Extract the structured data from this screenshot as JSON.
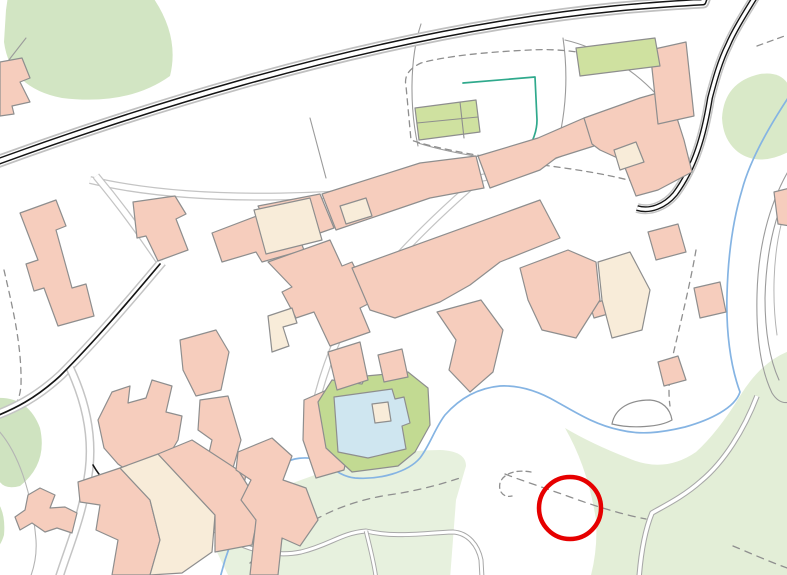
{
  "map": {
    "canvas": {
      "width": 787,
      "height": 575,
      "background": "#ffffff"
    },
    "colors": {
      "background": "#ffffff",
      "building_residential": "#f6cdbd",
      "building_secondary": "#f8ecd9",
      "building_public_green": "#cfe1a0",
      "building_outline": "#8e8e8e",
      "vegetation_dark": "#d2e5c3",
      "vegetation_mid": "#d9e9c8",
      "vegetation_pale": "#e7f1de",
      "pool_water": "#cfe6f0",
      "pool_garden": "#c2da92",
      "stream_blue": "#85b4e3",
      "hedge_teal": "#2fa98c",
      "road_casing_black": "#151515",
      "road_fill_white": "#ffffff",
      "road_casing_gray": "#c4c4c4",
      "track_gray": "#a8a8a8",
      "parcel_gray": "#9b9b9b",
      "path_dash_gray": "#8f8f8f",
      "annotation_red": "#e60000"
    },
    "features": [
      {
        "name": "vegetation-top-left",
        "kind": "area",
        "fill": "#d2e5c3",
        "d": "M8,-4 L152,-4 Q180,36 170,76 Q128,106 62,98 Q10,88 4,42 L6,10 Z"
      },
      {
        "name": "vegetation-right-top",
        "kind": "area",
        "fill": "#d9e9c8",
        "d": "M722,118 Q724,82 760,74 Q787,70 792,95 L792,150 Q760,168 738,152 Q723,140 722,118 Z"
      },
      {
        "name": "vegetation-left-mid",
        "kind": "area",
        "fill": "#cfe3c0",
        "d": "M-4,398 Q28,396 40,428 Q48,464 20,486 Q-2,492 -4,470 Z"
      },
      {
        "name": "vegetation-left-bottom-sliver",
        "kind": "area",
        "fill": "#cfe3c0",
        "d": "M-4,500 Q6,512 4,535 Q0,548 -4,546 Z"
      },
      {
        "name": "vegetation-bottom-center",
        "kind": "area",
        "fill": "#e7f1de",
        "d": "M230,579 L214,546 Q220,518 244,502 Q260,492 290,484 L345,464 Q395,450 440,450 Q466,451 466,466 L456,500 L450,579 Z"
      },
      {
        "name": "vegetation-bottom-right",
        "kind": "area",
        "fill": "#e3eed7",
        "d": "M565,428 Q588,468 596,520 Q598,550 590,579 L792,579 L792,350 Q762,360 740,396 Q718,432 696,452 Q664,474 628,458 Q592,444 565,428 Z"
      },
      {
        "name": "parcel-line-top-left",
        "kind": "line",
        "stroke": "#9b9b9b",
        "width": 1.1,
        "d": "M26,38 L-2,74"
      },
      {
        "name": "parcel-line-field-divider",
        "kind": "line",
        "stroke": "#9b9b9b",
        "width": 1.1,
        "d": "M310,118 L326,178"
      },
      {
        "name": "parcel-line-west",
        "kind": "line",
        "stroke": "#9b9b9b",
        "width": 1.1,
        "d": "M421,24 C409,60 410,110 418,146"
      },
      {
        "name": "parcel-line-south",
        "kind": "line",
        "stroke": "#9b9b9b",
        "width": 1.1,
        "d": "M418,143 C440,150 462,154 481,157"
      },
      {
        "name": "parcel-line-east",
        "kind": "line",
        "stroke": "#9b9b9b",
        "width": 1.1,
        "d": "M563,38 C568,72 567,112 556,150"
      },
      {
        "name": "parcel-line-northeast",
        "kind": "line",
        "stroke": "#9b9b9b",
        "width": 1.1,
        "d": "M565,40 C600,48 634,70 657,95 C667,108 668,124 661,138"
      },
      {
        "name": "trail-right-outer",
        "kind": "line",
        "stroke": "#9b9b9b",
        "width": 1.1,
        "d": "M790,168 C768,205 758,250 757,295 C756,335 760,368 772,393 C777,401 783,404 790,402"
      },
      {
        "name": "trail-right-inner",
        "kind": "line",
        "stroke": "#9b9b9b",
        "width": 1.1,
        "d": "M790,186 C773,218 766,258 765,298 C765,330 769,358 779,380"
      },
      {
        "name": "trail-right-hairpin",
        "kind": "line",
        "stroke": "#b4b4b4",
        "width": 1,
        "d": "M781,225 C773,258 772,300 777,335"
      },
      {
        "name": "boundary-bottom-left",
        "kind": "line",
        "stroke": "#b4b4b4",
        "width": 1.1,
        "d": "M-2,430 C18,452 32,492 36,540 C37,556 34,568 30,578"
      },
      {
        "name": "footpath-dashed-parcel-loop",
        "kind": "line",
        "stroke": "#8f8f8f",
        "width": 1.3,
        "dash": "6,5",
        "d": "M628,66 C600,54 565,48 530,50 C487,52 446,56 421,63 C408,69 404,77 406,86 L411,140 C440,150 492,158 542,165 C582,170 616,176 643,184"
      },
      {
        "name": "footpath-dashed-top-right",
        "kind": "line",
        "stroke": "#8f8f8f",
        "width": 1.3,
        "dash": "6,5",
        "d": "M757,46 L790,34"
      },
      {
        "name": "footpath-dashed-center-right",
        "kind": "line",
        "stroke": "#8f8f8f",
        "width": 1.3,
        "dash": "6,5",
        "d": "M696,250 C690,285 680,325 673,355 C669,375 668,392 670,406"
      },
      {
        "name": "footpath-dashed-left-edge",
        "kind": "line",
        "stroke": "#8f8f8f",
        "width": 1.3,
        "dash": "6,5",
        "d": "M4,270 C12,305 22,345 21,385 C20,400 14,410 6,416"
      },
      {
        "name": "footpath-dashed-bottom",
        "kind": "line",
        "stroke": "#8f8f8f",
        "width": 1.3,
        "dash": "7,6",
        "d": "M250,563 C262,552 290,532 322,516 C345,504 372,497 395,494 C420,490 442,484 460,478"
      },
      {
        "name": "footpath-dashed-through-circle",
        "kind": "line",
        "stroke": "#8f8f8f",
        "width": 1.3,
        "dash": "7,6",
        "d": "M505,474 C520,480 545,488 570,497 C592,505 620,514 646,519"
      },
      {
        "name": "footpath-dashed-corner",
        "kind": "line",
        "stroke": "#8f8f8f",
        "width": 1.3,
        "dash": "7,6",
        "d": "M733,546 C750,553 770,562 790,569"
      },
      {
        "name": "footpath-end-squiggle",
        "kind": "line",
        "stroke": "#8f8f8f",
        "width": 1.3,
        "dash": "5,4",
        "d": "M531,472 C515,469 503,474 500,483 C498,492 504,498 512,496"
      },
      {
        "name": "track-bottom-right",
        "kind": "road",
        "casing": "#a8a8a8",
        "casing_width": 5.5,
        "fill": "#ffffff",
        "fill_width": 3.4,
        "d": "M757,396 C744,430 724,462 701,481 C683,497 664,506 652,513 C645,530 641,552 639,578"
      },
      {
        "name": "track-bottom-center",
        "kind": "road",
        "casing": "#a8a8a8",
        "casing_width": 5,
        "fill": "#ffffff",
        "fill_width": 3,
        "d": "M211,528 C242,549 272,558 301,552 C330,545 341,533 366,531 C396,538 422,533 453,532 C468,533 478,545 481,560 L482,578"
      },
      {
        "name": "track-bottom-branch",
        "kind": "road",
        "casing": "#a8a8a8",
        "casing_width": 4.5,
        "fill": "#ffffff",
        "fill_width": 2.6,
        "d": "M366,531 C370,548 374,562 376,578"
      },
      {
        "name": "street-field-south",
        "kind": "road",
        "casing": "#c4c4c4",
        "casing_width": 8,
        "fill": "#ffffff",
        "fill_width": 5.5,
        "d": "M90,180 C200,206 360,198 470,180 C530,170 570,150 600,132 C622,120 648,120 672,135"
      },
      {
        "name": "street-village-diagonal",
        "kind": "road",
        "casing": "#c4c4c4",
        "casing_width": 8,
        "fill": "#ffffff",
        "fill_width": 5.5,
        "d": "M478,180 C420,230 372,280 342,330 C327,360 317,395 312,422"
      },
      {
        "name": "street-connector-north",
        "kind": "road",
        "casing": "#c4c4c4",
        "casing_width": 8,
        "fill": "#ffffff",
        "fill_width": 5.5,
        "d": "M160,262 C140,232 116,200 96,176"
      },
      {
        "name": "road-village-southwest",
        "kind": "road",
        "casing": "#c4c4c4",
        "casing_width": 10,
        "fill": "#ffffff",
        "fill_width": 7,
        "d": "M162,262 C130,300 96,340 61,375 C36,398 15,408 -6,416"
      },
      {
        "name": "road-village-south-branch",
        "kind": "road",
        "casing": "#c4c4c4",
        "casing_width": 9,
        "fill": "#ffffff",
        "fill_width": 6,
        "d": "M70,368 C86,402 93,436 89,470 C83,516 69,546 59,578"
      },
      {
        "name": "road-village-centerline",
        "kind": "line",
        "stroke": "#151515",
        "width": 1.7,
        "d": "M160,264 C128,302 95,341 60,376 C35,399 14,409 -6,417"
      },
      {
        "name": "road-village-branch-black-edge",
        "kind": "line",
        "stroke": "#151515",
        "width": 1.6,
        "d": "M93,465 C101,479 110,487 120,491"
      },
      {
        "name": "main-road-outer-casing",
        "kind": "road",
        "casing": "#c0c0c0",
        "casing_width": 13,
        "fill": "#ffffff",
        "fill_width": 9.5,
        "d": "M-6,163 C150,106 330,52 500,24 C590,9 650,5 703,2 L706,-6"
      },
      {
        "name": "main-road",
        "kind": "road",
        "casing": "#151515",
        "casing_width": 7,
        "fill": "#ffffff",
        "fill_width": 4,
        "d": "M-6,163 C150,106 330,52 500,24 C590,9 650,5 703,2 L706,-6"
      },
      {
        "name": "fork-road-outer-casing",
        "kind": "road",
        "casing": "#c4c4c4",
        "casing_width": 10,
        "fill": "#ffffff",
        "fill_width": 7,
        "d": "M757,-6 C742,18 733,33 728,45 C720,61 715,79 710,98 C704,135 695,167 675,194 C665,206 650,212 637,208"
      },
      {
        "name": "fork-road",
        "kind": "road",
        "casing": "#151515",
        "casing_width": 6,
        "fill": "#ffffff",
        "fill_width": 3.2,
        "d": "M757,-6 C742,18 733,33 728,45 C720,61 715,79 710,98 C704,135 695,167 675,194 C665,206 650,212 637,208"
      },
      {
        "name": "hedge-teal-line",
        "kind": "line",
        "stroke": "#2fa98c",
        "width": 1.7,
        "d": "M463,83 L535,77 L537,120 C537,135 530,145 526,153"
      },
      {
        "name": "stream",
        "kind": "line",
        "stroke": "#85b4e3",
        "width": 1.7,
        "d": "M790,95 C770,125 750,160 742,190 C733,220 728,255 727,295 C726,330 730,365 740,392 C735,408 710,420 685,427 C660,433 640,435 620,430 C595,425 575,412 557,402 C540,392 520,385 500,386 C478,388 460,398 445,415 C435,428 430,445 420,458 C408,472 380,480 355,478 C338,476 330,465 320,460 C305,456 292,458 283,464 C270,472 262,485 255,495 C240,515 230,545 225,560 L220,578"
      },
      {
        "name": "enclosure-by-stream",
        "kind": "area",
        "fill": "#ffffff",
        "stroke": "#8e8e8e",
        "stroke_width": 1.2,
        "d": "M612,424 C615,408 630,400 650,400 C662,401 670,408 672,420 C660,427 632,429 612,424 Z"
      },
      {
        "name": "building",
        "kind": "building",
        "fill": "#f6cdbd",
        "points": "0,62 22,58 30,78 20,82 30,102 12,106 14,114 0,116"
      },
      {
        "name": "building",
        "kind": "building",
        "fill": "#f6cdbd",
        "points": "20,213 56,200 66,226 56,230 72,288 86,284 94,316 58,326 44,288 34,291 26,264 38,260"
      },
      {
        "name": "building",
        "kind": "building",
        "fill": "#f6cdbd",
        "points": "133,202 175,196 186,214 176,219 188,250 158,261 146,236 137,238"
      },
      {
        "name": "building",
        "kind": "building",
        "fill": "#f6cdbd",
        "points": "212,233 262,214 258,206 320,194 334,228 300,240 304,250 262,262 256,252 222,262"
      },
      {
        "name": "building",
        "kind": "building",
        "fill": "#f6cdbd",
        "points": "322,194 420,163 476,156 484,188 430,198 336,230"
      },
      {
        "name": "building-secondary",
        "kind": "building",
        "fill": "#f8ecd9",
        "points": "254,210 310,198 322,240 266,254"
      },
      {
        "name": "building-secondary",
        "kind": "building",
        "fill": "#f8ecd9",
        "points": "340,206 366,198 372,216 346,224"
      },
      {
        "name": "building",
        "kind": "building",
        "fill": "#f6cdbd",
        "points": "478,156 538,138 584,118 594,146 556,158 540,170 490,188"
      },
      {
        "name": "building",
        "kind": "building",
        "fill": "#f6cdbd",
        "points": "584,118 640,98 668,90 684,140 692,172 658,190 636,196 622,160 600,150 592,144"
      },
      {
        "name": "building-secondary",
        "kind": "building",
        "fill": "#f8ecd9",
        "points": "614,150 636,142 644,162 620,170"
      },
      {
        "name": "building",
        "kind": "building",
        "fill": "#f6cdbd",
        "points": "650,50 686,42 694,116 658,124"
      },
      {
        "name": "building",
        "kind": "building",
        "fill": "#f6cdbd",
        "points": "774,192 790,188 790,226 778,224"
      },
      {
        "name": "building",
        "kind": "building",
        "fill": "#f6cdbd",
        "points": "590,305 604,300 608,314 594,318"
      },
      {
        "name": "building",
        "kind": "building",
        "fill": "#f6cdbd",
        "points": "268,262 330,240 342,266 352,262 372,302 360,308 370,332 330,346 314,312 296,318 282,292 292,287"
      },
      {
        "name": "building-secondary",
        "kind": "building",
        "fill": "#f8ecd9",
        "points": "268,316 292,308 297,323 283,327 289,346 272,352"
      },
      {
        "name": "building",
        "kind": "building",
        "fill": "#f6cdbd",
        "points": "352,268 540,200 560,238 500,262 470,285 440,302 395,318 370,310"
      },
      {
        "name": "building",
        "kind": "building",
        "fill": "#f6cdbd",
        "points": "437,312 481,300 503,330 493,372 470,392 449,370 456,340"
      },
      {
        "name": "building",
        "kind": "building",
        "fill": "#f6cdbd",
        "points": "520,268 568,250 596,262 600,300 576,338 542,330 528,300"
      },
      {
        "name": "building-secondary",
        "kind": "building",
        "fill": "#f8ecd9",
        "points": "598,262 630,252 650,290 642,330 612,338 602,300"
      },
      {
        "name": "building",
        "kind": "building",
        "fill": "#f6cdbd",
        "points": "648,232 678,224 686,252 656,260"
      },
      {
        "name": "building",
        "kind": "building",
        "fill": "#f6cdbd",
        "points": "694,288 720,282 726,312 700,318"
      },
      {
        "name": "building",
        "kind": "building",
        "fill": "#f6cdbd",
        "points": "658,362 678,356 686,380 664,386"
      },
      {
        "name": "building",
        "kind": "building",
        "fill": "#f6cdbd",
        "points": "98,420 112,392 130,386 128,403 146,398 152,380 172,386 166,412 182,416 178,440 160,470 138,478 118,464 104,448"
      },
      {
        "name": "building",
        "kind": "building",
        "fill": "#f6cdbd",
        "points": "180,340 216,330 229,352 221,390 196,396 183,370"
      },
      {
        "name": "building",
        "kind": "building",
        "fill": "#f6cdbd",
        "points": "200,400 228,396 241,440 233,468 246,474 240,506 214,515 205,470 212,440 198,430"
      },
      {
        "name": "building",
        "kind": "building",
        "fill": "#f6cdbd",
        "points": "28,495 40,488 55,495 50,508 65,507 77,513 72,533 57,528 45,532 32,523 20,530 15,517 25,510"
      },
      {
        "name": "building",
        "kind": "building",
        "fill": "#f6cdbd",
        "points": "78,482 120,468 150,500 160,540 150,575 112,575 118,540 96,530 100,505 80,502"
      },
      {
        "name": "building-secondary",
        "kind": "building",
        "fill": "#f8ecd9",
        "points": "120,468 158,454 215,515 212,552 182,573 150,575 160,540 150,500"
      },
      {
        "name": "building",
        "kind": "building",
        "fill": "#f6cdbd",
        "points": "158,454 192,440 238,470 260,505 252,545 215,552 215,515"
      },
      {
        "name": "building",
        "kind": "building",
        "fill": "#f6cdbd",
        "points": "238,452 272,438 292,456 283,480 306,488 318,520 300,546 282,538 278,575 250,575 256,520 241,500 251,480 236,470"
      },
      {
        "name": "building",
        "kind": "building",
        "fill": "#f6cdbd",
        "points": "304,400 336,386 354,422 344,470 316,478 303,440"
      },
      {
        "name": "greenhouse-complex",
        "kind": "building",
        "fill": "#cfe1a0",
        "points": "415,108 476,100 480,132 419,140"
      },
      {
        "name": "greenhouse-divider",
        "kind": "line",
        "stroke": "#8e8e8e",
        "width": 1.1,
        "d": "M417,123 L478,117"
      },
      {
        "name": "greenhouse-divider",
        "kind": "line",
        "stroke": "#8e8e8e",
        "width": 1.1,
        "d": "M460,102 L464,138"
      },
      {
        "name": "green-building-northeast",
        "kind": "building",
        "fill": "#cfe1a0",
        "points": "576,48 655,38 660,66 580,76"
      },
      {
        "name": "pool-garden",
        "kind": "building",
        "fill": "#c2da92",
        "points": "318,402 332,380 362,384 366,376 408,372 428,388 430,425 415,452 398,466 352,472 326,448"
      },
      {
        "name": "swimming-pool",
        "kind": "building",
        "fill": "#cfe6f0",
        "points": "334,397 392,389 395,399 404,397 410,423 402,426 406,449 368,458 338,452"
      },
      {
        "name": "pool-house",
        "kind": "building",
        "fill": "#f8ecd9",
        "points": "372,404 388,402 391,421 375,423"
      },
      {
        "name": "building",
        "kind": "building",
        "fill": "#f6cdbd",
        "points": "328,352 360,342 368,380 337,390"
      },
      {
        "name": "building",
        "kind": "building",
        "fill": "#f6cdbd",
        "points": "378,355 402,349 408,377 384,382"
      }
    ],
    "annotation": {
      "name": "highlight-circle",
      "shape": "circle",
      "cx": 570,
      "cy": 508,
      "r": 31,
      "stroke": "#e60000",
      "stroke_width": 4.5
    }
  }
}
